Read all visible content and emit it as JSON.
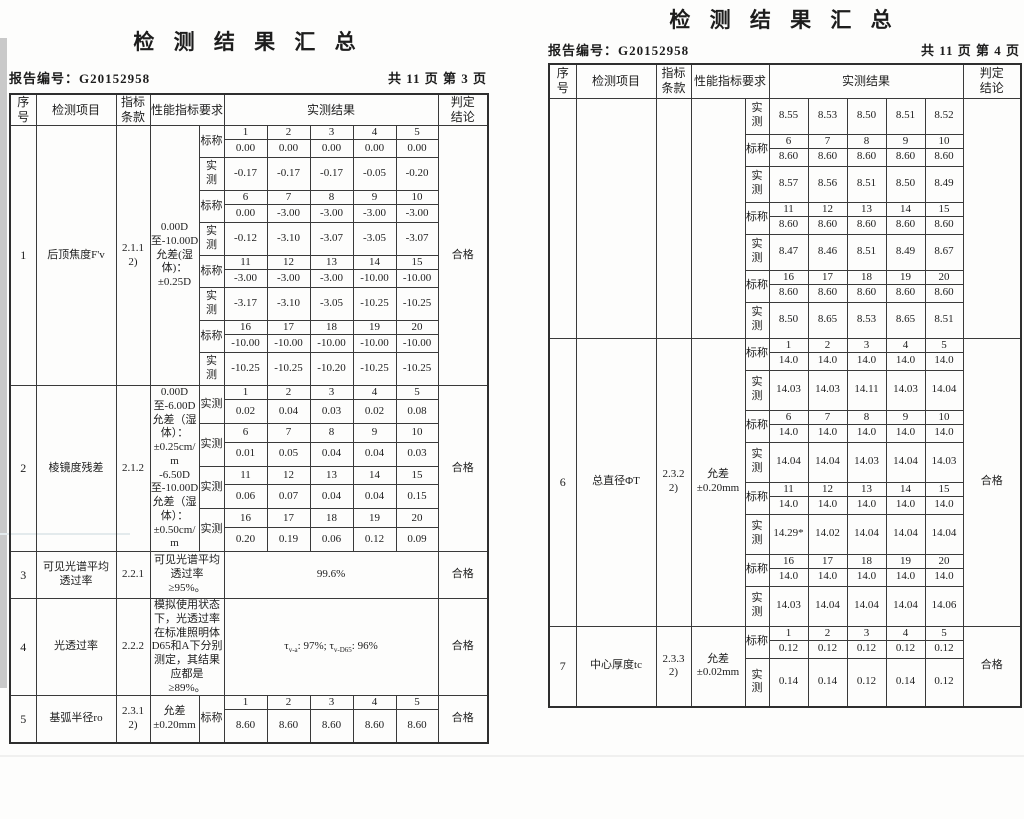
{
  "pages": [
    {
      "title": "检 测 结 果 汇 总",
      "report_line": "报告编号：G20152958",
      "page_info": "共 11 页 第 3 页",
      "headers": {
        "seq": "序\n号",
        "item": "检测项目",
        "clause": "指标\n条款",
        "req": "性能指标要求",
        "result": "实测结果",
        "verdict": "判定\n结论"
      },
      "sections": [
        {
          "seq": "1",
          "item": "后顶焦度F'v",
          "clause": "2.1.1\n2)",
          "req": "0.00D\n至-10.00D\n允差(湿\n体)：\n±0.25D",
          "verdict": "合格",
          "blocks": [
            {
              "label": "标称",
              "idx": [
                "1",
                "2",
                "3",
                "4",
                "5"
              ],
              "vals": [
                "0.00",
                "0.00",
                "0.00",
                "0.00",
                "0.00"
              ],
              "vh": 18
            },
            {
              "label": "实\n测",
              "vals": [
                "-0.17",
                "-0.17",
                "-0.17",
                "-0.05",
                "-0.20"
              ],
              "vh": 33
            },
            {
              "label": "标称",
              "idx": [
                "6",
                "7",
                "8",
                "9",
                "10"
              ],
              "vals": [
                "0.00",
                "-3.00",
                "-3.00",
                "-3.00",
                "-3.00"
              ],
              "vh": 18
            },
            {
              "label": "实\n测",
              "vals": [
                "-0.12",
                "-3.10",
                "-3.07",
                "-3.05",
                "-3.07"
              ],
              "vh": 33
            },
            {
              "label": "标称",
              "idx": [
                "11",
                "12",
                "13",
                "14",
                "15"
              ],
              "vals": [
                "-3.00",
                "-3.00",
                "-3.00",
                "-10.00",
                "-10.00"
              ],
              "vh": 18
            },
            {
              "label": "实\n测",
              "vals": [
                "-3.17",
                "-3.10",
                "-3.05",
                "-10.25",
                "-10.25"
              ],
              "vh": 33
            },
            {
              "label": "标称",
              "idx": [
                "16",
                "17",
                "18",
                "19",
                "20"
              ],
              "vals": [
                "-10.00",
                "-10.00",
                "-10.00",
                "-10.00",
                "-10.00"
              ],
              "vh": 18
            },
            {
              "label": "实\n测",
              "vals": [
                "-10.25",
                "-10.25",
                "-10.20",
                "-10.25",
                "-10.25"
              ],
              "vh": 33
            }
          ]
        },
        {
          "seq": "2",
          "item": "棱镜度残差",
          "clause": "2.1.2",
          "req": "0.00D\n至-6.00D\n允差（湿\n体）：\n±0.25cm/\nm\n-6.50D\n至-10.00D\n允差（湿\n体）：\n±0.50cm/\nm",
          "verdict": "合格",
          "blocks": [
            {
              "label": "实测",
              "idx": [
                "1",
                "2",
                "3",
                "4",
                "5"
              ],
              "vals": [
                "0.02",
                "0.04",
                "0.03",
                "0.02",
                "0.08"
              ],
              "vh": 24
            },
            {
              "label": "实测",
              "idx": [
                "6",
                "7",
                "8",
                "9",
                "10"
              ],
              "vals": [
                "0.01",
                "0.05",
                "0.04",
                "0.04",
                "0.03"
              ],
              "vh": 24
            },
            {
              "label": "实测",
              "idx": [
                "11",
                "12",
                "13",
                "14",
                "15"
              ],
              "vals": [
                "0.06",
                "0.07",
                "0.04",
                "0.04",
                "0.15"
              ],
              "vh": 24
            },
            {
              "label": "实测",
              "idx": [
                "16",
                "17",
                "18",
                "19",
                "20"
              ],
              "vals": [
                "0.20",
                "0.19",
                "0.06",
                "0.12",
                "0.09"
              ],
              "vh": 24
            }
          ]
        },
        {
          "seq": "3",
          "item": "可见光谱平均\n透过率",
          "clause": "2.2.1",
          "req": "可见光谱平均\n透过率\n≥95%。",
          "result": "99.6%",
          "verdict": "合格",
          "h": 47
        },
        {
          "seq": "4",
          "item": "光透过率",
          "clause": "2.2.2",
          "req": "模拟使用状态\n下，光透过率\n在标准照明体\nD65和A下分别\n测定，其结果\n应都是\n≥89%。",
          "result": "τ_{v-a}: 97%; τ_{v-D65}: 96%",
          "verdict": "合格",
          "h": 74
        },
        {
          "seq": "5",
          "item": "基弧半径ro",
          "clause": "2.3.1\n2)",
          "req": "允差\n±0.20mm",
          "verdict": "合格",
          "blocks": [
            {
              "label": "标称",
              "idx": [
                "1",
                "2",
                "3",
                "4",
                "5"
              ],
              "vals": [
                "8.60",
                "8.60",
                "8.60",
                "8.60",
                "8.60"
              ],
              "vh": 33
            }
          ]
        }
      ]
    },
    {
      "title": "检 测 结 果 汇 总",
      "report_line": "报告编号：G20152958",
      "page_info": "共 11 页 第 4 页",
      "headers": {
        "seq": "序\n号",
        "item": "检测项目",
        "clause": "指标\n条款",
        "req": "性能指标要求",
        "result": "实测结果",
        "verdict": "判定\n结论"
      },
      "sections": [
        {
          "seq": "",
          "item": "",
          "clause": "",
          "req": "",
          "verdict": "",
          "blocks": [
            {
              "label": "实\n测",
              "vals": [
                "8.55",
                "8.53",
                "8.50",
                "8.51",
                "8.52"
              ],
              "vh": 36
            },
            {
              "label": "标称",
              "idx": [
                "6",
                "7",
                "8",
                "9",
                "10"
              ],
              "vals": [
                "8.60",
                "8.60",
                "8.60",
                "8.60",
                "8.60"
              ],
              "vh": 18
            },
            {
              "label": "实\n测",
              "vals": [
                "8.57",
                "8.56",
                "8.51",
                "8.50",
                "8.49"
              ],
              "vh": 36
            },
            {
              "label": "标称",
              "idx": [
                "11",
                "12",
                "13",
                "14",
                "15"
              ],
              "vals": [
                "8.60",
                "8.60",
                "8.60",
                "8.60",
                "8.60"
              ],
              "vh": 18
            },
            {
              "label": "实\n测",
              "vals": [
                "8.47",
                "8.46",
                "8.51",
                "8.49",
                "8.67"
              ],
              "vh": 36
            },
            {
              "label": "标称",
              "idx": [
                "16",
                "17",
                "18",
                "19",
                "20"
              ],
              "vals": [
                "8.60",
                "8.60",
                "8.60",
                "8.60",
                "8.60"
              ],
              "vh": 18
            },
            {
              "label": "实\n测",
              "vals": [
                "8.50",
                "8.65",
                "8.53",
                "8.65",
                "8.51"
              ],
              "vh": 36
            }
          ]
        },
        {
          "seq": "6",
          "item": "总直径ΦT",
          "clause": "2.3.2\n2)",
          "req": "允差\n±0.20mm",
          "verdict": "合格",
          "blocks": [
            {
              "label": "标称",
              "idx": [
                "1",
                "2",
                "3",
                "4",
                "5"
              ],
              "vals": [
                "14.0",
                "14.0",
                "14.0",
                "14.0",
                "14.0"
              ],
              "vh": 18
            },
            {
              "label": "实\n测",
              "vals": [
                "14.03",
                "14.03",
                "14.11",
                "14.03",
                "14.04"
              ],
              "vh": 40
            },
            {
              "label": "标称",
              "idx": [
                "6",
                "7",
                "8",
                "9",
                "10"
              ],
              "vals": [
                "14.0",
                "14.0",
                "14.0",
                "14.0",
                "14.0"
              ],
              "vh": 18
            },
            {
              "label": "实\n测",
              "vals": [
                "14.04",
                "14.04",
                "14.03",
                "14.04",
                "14.03"
              ],
              "vh": 40
            },
            {
              "label": "标称",
              "idx": [
                "11",
                "12",
                "13",
                "14",
                "15"
              ],
              "vals": [
                "14.0",
                "14.0",
                "14.0",
                "14.0",
                "14.0"
              ],
              "vh": 18
            },
            {
              "label": "实\n测",
              "vals": [
                "14.29*",
                "14.02",
                "14.04",
                "14.04",
                "14.04"
              ],
              "vh": 40
            },
            {
              "label": "标称",
              "idx": [
                "16",
                "17",
                "18",
                "19",
                "20"
              ],
              "vals": [
                "14.0",
                "14.0",
                "14.0",
                "14.0",
                "14.0"
              ],
              "vh": 18
            },
            {
              "label": "实\n测",
              "vals": [
                "14.03",
                "14.04",
                "14.04",
                "14.04",
                "14.06"
              ],
              "vh": 40
            }
          ]
        },
        {
          "seq": "7",
          "item": "中心厚度tc",
          "clause": "2.3.3\n2)",
          "req": "允差\n±0.02mm",
          "verdict": "合格",
          "blocks": [
            {
              "label": "标称",
              "idx": [
                "1",
                "2",
                "3",
                "4",
                "5"
              ],
              "vals": [
                "0.12",
                "0.12",
                "0.12",
                "0.12",
                "0.12"
              ],
              "vh": 18
            },
            {
              "label": "实\n测",
              "vals": [
                "0.14",
                "0.14",
                "0.12",
                "0.14",
                "0.12"
              ],
              "vh": 49
            }
          ]
        }
      ]
    }
  ]
}
